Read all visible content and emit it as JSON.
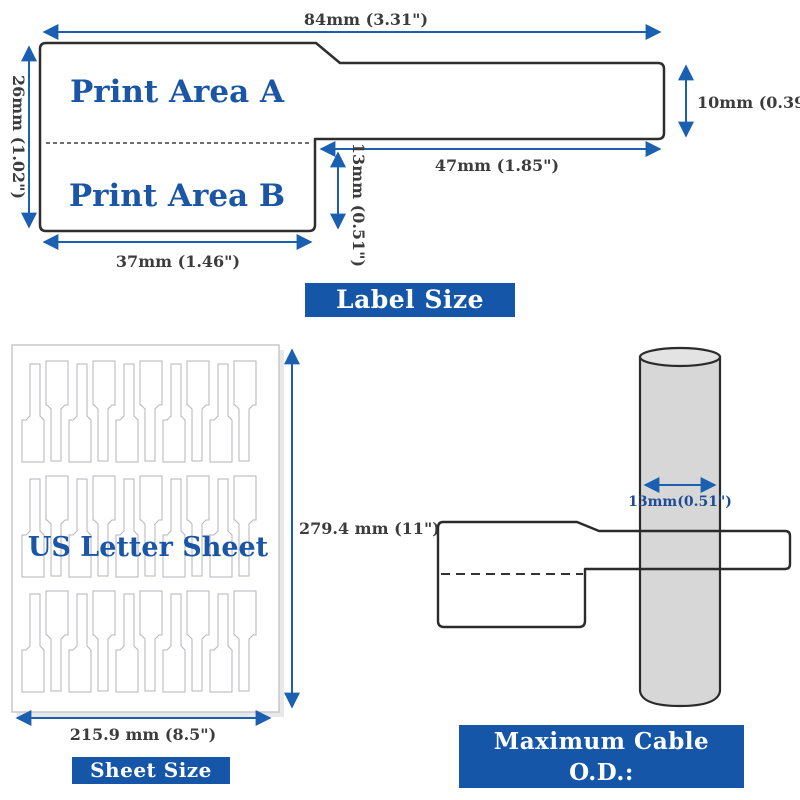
{
  "colors": {
    "arrow_blue": "#1a5fb0",
    "banner_blue": "#1656a8",
    "label_text_blue": "#1b55a5",
    "dimension_text_gray": "#3c3c3c"
  },
  "label_diagram": {
    "print_area_a": "Print Area A",
    "print_area_b": "Print Area B",
    "dims": {
      "total_width": "84mm (3.31\")",
      "body_height": "26mm (1.02\")",
      "tail_height": "10mm (0.39\")",
      "tail_length": "47mm (1.85\")",
      "wrap_height": "13mm (0.51\")",
      "body_width": "37mm (1.46\")"
    },
    "banner": "Label Size"
  },
  "sheet_diagram": {
    "title": "US Letter Sheet",
    "dims": {
      "height": "279.4 mm (11\")",
      "width": "215.9 mm (8.5\")"
    },
    "banner": "Sheet Size",
    "rows": 3,
    "labels_per_row": 10
  },
  "cable_diagram": {
    "cable_diameter": "13mm(0.51\")",
    "banner_line1": "Maximum Cable O.D.:",
    "banner_line2": "13mm(0.51\")"
  }
}
